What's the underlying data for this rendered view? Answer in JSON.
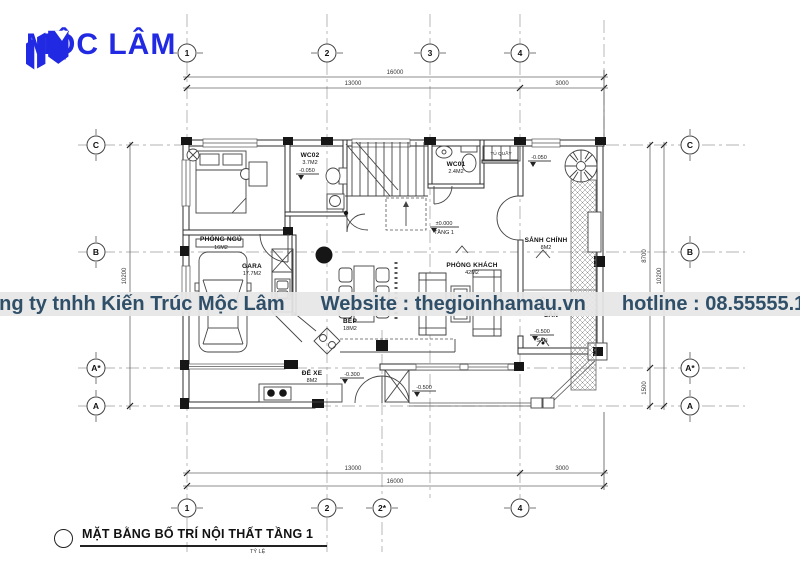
{
  "logo": {
    "name": "MỘC LÂM"
  },
  "watermark": {
    "company": "Công ty tnhh Kiến Trúc Mộc Lâm",
    "website": "Website : thegioinhamau.vn",
    "hotline": "hotline : 08.55555.181"
  },
  "title_block": {
    "title": "MẶT BẰNG BỐ TRÍ NỘI THẤT TẦNG 1",
    "scale_label": "TỶ LỆ"
  },
  "axes": {
    "top1": "1",
    "top2": "2",
    "top3": "3",
    "top4": "4",
    "bottom1": "1",
    "bottom2": "2",
    "bottom2s": "2*",
    "bottom4": "4",
    "leftC": "C",
    "leftB": "B",
    "leftAs": "A*",
    "leftA": "A",
    "rightC": "C",
    "rightB": "B",
    "rightAs": "A*",
    "rightA": "A"
  },
  "dims": {
    "top_total": "16000",
    "top_seg1": "13000",
    "top_seg2": "3000",
    "bottom_seg1": "13000",
    "bottom_seg2": "3000",
    "bottom_total": "16000",
    "left_total": "10200",
    "right_seg1": "8700",
    "right_seg2": "1500",
    "right_total": "10200"
  },
  "rooms": {
    "bedroom": {
      "name": "PHÒNG NGỦ",
      "area": "16M2"
    },
    "wc02": {
      "name": "WC02",
      "area": "3.7M2"
    },
    "wc01": {
      "name": "WC01",
      "area": "2.4M2"
    },
    "cabinet": {
      "name": "TỦ QUẦY"
    },
    "hall": {
      "name": "SẢNH CHÍNH",
      "area": "8M2"
    },
    "living": {
      "name": "PHÒNG KHÁCH",
      "area": "42M2"
    },
    "garage": {
      "name": "GARA",
      "area": "17.7M2"
    },
    "kitchen": {
      "name": "BẾP",
      "area": "18M2"
    },
    "bike": {
      "name": "ĐỂ XE",
      "area": "8M2"
    },
    "yard": {
      "name": "SÂN"
    }
  },
  "levels": {
    "wc02": "-0.050",
    "hall": "-0.050",
    "floor_value": "±0.000",
    "floor_label": "TẦNG 1",
    "bike": "-0.300",
    "entry": "-0.500",
    "yard_value": "-0.500",
    "yard_label": "SÂN"
  }
}
